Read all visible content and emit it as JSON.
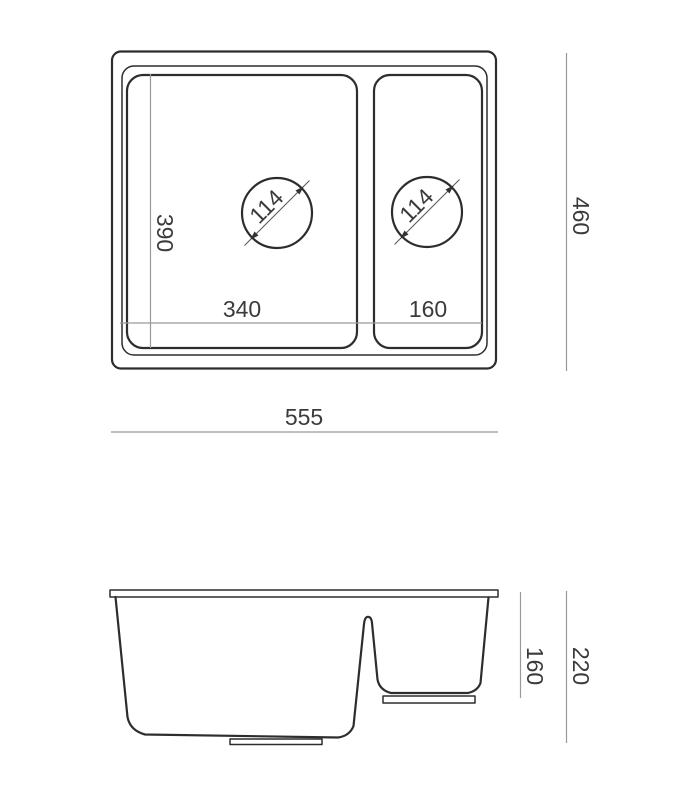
{
  "title": "Sink technical drawing with dimensions (mm)",
  "colors": {
    "line": "#2d2d2d",
    "dimension_line": "#9a9a9a",
    "text": "#3b3b3b",
    "background": "#ffffff"
  },
  "top_view": {
    "overall_width": "555",
    "overall_depth": "460",
    "main_bowl": {
      "width": "340",
      "inner_depth": "390",
      "drain_diameter": "114"
    },
    "half_bowl": {
      "width": "160",
      "drain_diameter": "114"
    }
  },
  "side_view": {
    "half_bowl_depth": "160",
    "overall_height": "220"
  }
}
